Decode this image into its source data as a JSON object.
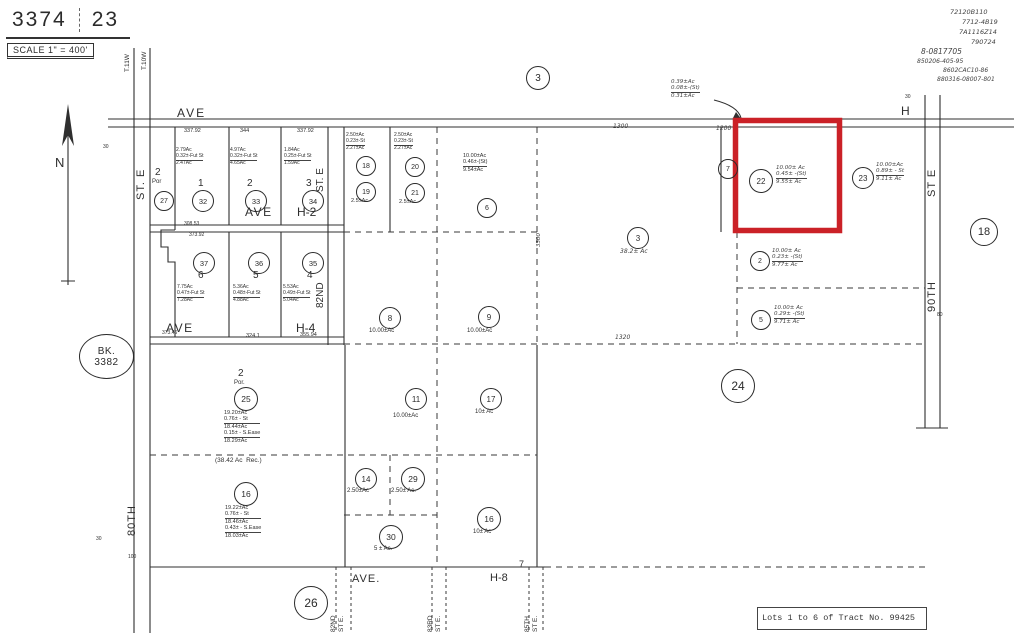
{
  "header": {
    "sheet_number": "3374",
    "page_number": "23",
    "scale_text": "SCALE 1\" = 400'"
  },
  "book": {
    "line1": "BK.",
    "line2": "3382"
  },
  "caption": {
    "text": "Lots 1 to 6 of Tract No. 99425"
  },
  "highlight_color": "#cb2127",
  "handwritten_notes": [
    {
      "name": "recorder-note-1",
      "text": "72120B110",
      "x": 950,
      "y": 9,
      "size": 6.5
    },
    {
      "name": "recorder-note-2",
      "text": "7712-4B19",
      "x": 962,
      "y": 19,
      "size": 6.5
    },
    {
      "name": "recorder-note-3",
      "text": "7A1116Z14",
      "x": 959,
      "y": 29,
      "size": 6.5
    },
    {
      "name": "recorder-note-4",
      "text": "790724",
      "x": 971,
      "y": 39,
      "size": 6.5
    },
    {
      "name": "recorder-note-5",
      "text": "8-0817705",
      "x": 921,
      "y": 48,
      "size": 7.5
    },
    {
      "name": "recorder-note-6",
      "text": "850206-405-95",
      "x": 917,
      "y": 58,
      "size": 6
    },
    {
      "name": "recorder-note-7",
      "text": "8602CAC10-86",
      "x": 943,
      "y": 67,
      "size": 6
    },
    {
      "name": "recorder-note-8",
      "text": "880316-08007-801",
      "x": 937,
      "y": 76,
      "size": 6
    }
  ],
  "labels": [
    {
      "name": "township-label-t11w",
      "text": "T.11W",
      "x": 124,
      "y": 72,
      "size": 6.5,
      "rot": 1
    },
    {
      "name": "township-label-t10w",
      "text": "T.10W",
      "x": 141,
      "y": 70,
      "size": 6.5,
      "rot": 1
    },
    {
      "name": "north-label",
      "text": "N",
      "x": 55,
      "y": 155,
      "size": 13
    },
    {
      "name": "ave-h-label-west",
      "text": "AVE",
      "x": 177,
      "y": 106,
      "size": 12,
      "spacing": 2
    },
    {
      "name": "ave-h-label-east",
      "text": "H",
      "x": 901,
      "y": 104,
      "size": 12
    },
    {
      "name": "dim-337-92-a",
      "text": "337.92",
      "x": 184,
      "y": 128,
      "size": 5.5
    },
    {
      "name": "dim-344",
      "text": "344",
      "x": 240,
      "y": 128,
      "size": 5.5
    },
    {
      "name": "dim-337-92-b",
      "text": "337.92",
      "x": 297,
      "y": 128,
      "size": 5.5
    },
    {
      "name": "dim-1300",
      "text": "1300",
      "x": 613,
      "y": 123,
      "size": 6,
      "hand": 1
    },
    {
      "name": "dim-1200",
      "text": "1200",
      "x": 716,
      "y": 125,
      "size": 6,
      "hand": 1
    },
    {
      "name": "lot-2-por-number",
      "text": "2",
      "x": 155,
      "y": 167,
      "size": 10
    },
    {
      "name": "lot-2-por-label",
      "text": "Por",
      "x": 152,
      "y": 179,
      "size": 6
    },
    {
      "name": "lot-1-number",
      "text": "1",
      "x": 198,
      "y": 178,
      "size": 10
    },
    {
      "name": "lot-2-number",
      "text": "2",
      "x": 247,
      "y": 178,
      "size": 10
    },
    {
      "name": "lot-3-number",
      "text": "3",
      "x": 306,
      "y": 178,
      "size": 10
    },
    {
      "name": "ave-h2-label-ave",
      "text": "AVE",
      "x": 245,
      "y": 205,
      "size": 12,
      "spacing": 1.5
    },
    {
      "name": "ave-h2-label-h2",
      "text": "H-2",
      "x": 297,
      "y": 205,
      "size": 12
    },
    {
      "name": "lot-1-acreage",
      "lines": [
        "2.79Ac",
        "0.32±-Fut St",
        "2.47Ac"
      ],
      "x": 176,
      "y": 148,
      "size": 5,
      "bars": [
        1
      ]
    },
    {
      "name": "lot-2-acreage",
      "lines": [
        "4.97Ac",
        "0.32±-Fut St",
        "4.65Ac"
      ],
      "x": 230,
      "y": 148,
      "size": 5,
      "bars": [
        1
      ]
    },
    {
      "name": "lot-3-acreage",
      "lines": [
        "1.84Ac",
        "0.25±-Fut St",
        "1.59Ac"
      ],
      "x": 284,
      "y": 148,
      "size": 5,
      "bars": [
        1
      ]
    },
    {
      "name": "street-80th-st-e-upper",
      "text": "ST. E",
      "x": 135,
      "y": 200,
      "size": 11,
      "rot": 1,
      "spacing": 1
    },
    {
      "name": "street-80th-label",
      "text": "80TH",
      "x": 126,
      "y": 536,
      "size": 11,
      "rot": 1,
      "spacing": 1
    },
    {
      "name": "tick-30-top-left",
      "text": "30",
      "x": 103,
      "y": 145,
      "size": 5
    },
    {
      "name": "tick-30-bottom-left",
      "text": "30",
      "x": 96,
      "y": 537,
      "size": 5
    },
    {
      "name": "tick-100-bottom-left",
      "text": "100",
      "x": 128,
      "y": 555,
      "size": 5
    },
    {
      "name": "street-82nd-st-e-upper",
      "text": "ST. E",
      "x": 315,
      "y": 192,
      "size": 10,
      "rot": 1
    },
    {
      "name": "street-82nd-label",
      "text": "82ND",
      "x": 315,
      "y": 308,
      "size": 10,
      "rot": 1
    },
    {
      "name": "lot-6-number",
      "text": "6",
      "x": 198,
      "y": 270,
      "size": 10
    },
    {
      "name": "lot-5-number",
      "text": "5",
      "x": 253,
      "y": 270,
      "size": 10
    },
    {
      "name": "lot-4-number",
      "text": "4",
      "x": 307,
      "y": 270,
      "size": 10
    },
    {
      "name": "ave-h4-label-ave",
      "text": "AVE",
      "x": 166,
      "y": 321,
      "size": 12,
      "spacing": 1.5
    },
    {
      "name": "ave-h4-label-h4",
      "text": "H-4",
      "x": 296,
      "y": 321,
      "size": 12
    },
    {
      "name": "lot-6-acreage",
      "lines": [
        "7.75Ac",
        "0.47±-Fut St",
        "7.28Ac"
      ],
      "x": 177,
      "y": 285,
      "size": 5,
      "bars": [
        1
      ]
    },
    {
      "name": "lot-5-acreage",
      "lines": [
        "5.36Ac",
        "0.48±-Fut St",
        "4.88Ac"
      ],
      "x": 233,
      "y": 285,
      "size": 5,
      "bars": [
        1
      ]
    },
    {
      "name": "lot-4-acreage",
      "lines": [
        "5.53Ac",
        "0.49±-Fut St",
        "5.04Ac"
      ],
      "x": 283,
      "y": 285,
      "size": 5,
      "bars": [
        1
      ]
    },
    {
      "name": "dim-308-53",
      "text": "308.53",
      "x": 184,
      "y": 222,
      "size": 5
    },
    {
      "name": "dim-373-92",
      "text": "373.92",
      "x": 189,
      "y": 233,
      "size": 5
    },
    {
      "name": "dim-373-46",
      "text": "373.46",
      "x": 162,
      "y": 331,
      "size": 5
    },
    {
      "name": "dim-324-1",
      "text": "324.1",
      "x": 246,
      "y": 333,
      "size": 5.5
    },
    {
      "name": "dim-355-94",
      "text": "355.94",
      "x": 300,
      "y": 332,
      "size": 5.5
    },
    {
      "name": "parcel-18-acreage",
      "lines": [
        "2.50±Ac",
        "0.23±-St",
        "2.27±Ac"
      ],
      "x": 346,
      "y": 133,
      "size": 5,
      "bars": [
        1
      ]
    },
    {
      "name": "parcel-20-acreage",
      "lines": [
        "2.50±Ac",
        "0.23±-St",
        "2.27±Ac"
      ],
      "x": 394,
      "y": 133,
      "size": 5,
      "bars": [
        1
      ]
    },
    {
      "name": "parcel-19-acreage",
      "text": "2.5±Ac",
      "x": 351,
      "y": 198,
      "size": 5.5
    },
    {
      "name": "parcel-21-acreage",
      "text": "2.5±Ac",
      "x": 399,
      "y": 199,
      "size": 5.5
    },
    {
      "name": "parcel-6-acreage",
      "lines": [
        "10.00±Ac",
        "0.46±-(St)",
        "9.54±Ac"
      ],
      "x": 463,
      "y": 153,
      "size": 5.5,
      "bars": [
        1
      ]
    },
    {
      "name": "parcel-8-acreage",
      "text": "10.00±Ac",
      "x": 369,
      "y": 328,
      "size": 6
    },
    {
      "name": "parcel-9-acreage",
      "text": "10.00±Ac",
      "x": 467,
      "y": 328,
      "size": 6
    },
    {
      "name": "parcel-3-acreage",
      "text": "38.2± Ac",
      "x": 620,
      "y": 248,
      "size": 6,
      "hand": 1
    },
    {
      "name": "dim-1320",
      "text": "1320",
      "x": 615,
      "y": 334,
      "size": 6,
      "hand": 1
    },
    {
      "name": "dim-3300",
      "text": "3300",
      "x": 536,
      "y": 247,
      "size": 5.5,
      "rot": 1,
      "hand": 1
    },
    {
      "name": "road-widening-note",
      "lines": [
        "0.39±Ac",
        "0.08±-(St)",
        "0.31±Ac"
      ],
      "x": 671,
      "y": 79,
      "size": 5.5,
      "hand": 1,
      "bars": [
        1
      ]
    },
    {
      "name": "parcel-22-acreage",
      "lines": [
        "10.00± Ac",
        "0.45± -(St)",
        "9.55± Ac"
      ],
      "x": 776,
      "y": 165,
      "size": 5.5,
      "hand": 1,
      "bars": [
        1
      ]
    },
    {
      "name": "parcel-23-acreage",
      "lines": [
        "10.00±Ac",
        "0.89± - St",
        "9.11± Ac"
      ],
      "x": 876,
      "y": 162,
      "size": 5.5,
      "hand": 1,
      "bars": [
        1
      ]
    },
    {
      "name": "parcel-2-acreage",
      "lines": [
        "10.00± Ac",
        "0.23± -(St)",
        "9.77± Ac"
      ],
      "x": 772,
      "y": 248,
      "size": 5.5,
      "hand": 1,
      "bars": [
        1
      ]
    },
    {
      "name": "parcel-5-acreage",
      "lines": [
        "10.00± Ac",
        "0.29± -(St)",
        "9.71± Ac"
      ],
      "x": 774,
      "y": 305,
      "size": 5.5,
      "hand": 1,
      "bars": [
        1
      ]
    },
    {
      "name": "lot-2-por-south-number",
      "text": "2",
      "x": 238,
      "y": 368,
      "size": 10
    },
    {
      "name": "lot-2-por-south-label",
      "text": "Por.",
      "x": 234,
      "y": 380,
      "size": 6
    },
    {
      "name": "parcel-25-acreage",
      "lines": [
        "19.20±Ac",
        "0.76± - St",
        "18.44±Ac",
        "0.15± - S.Ease",
        "18.29±Ac"
      ],
      "x": 224,
      "y": 410,
      "size": 5.5,
      "bars": [
        1,
        3
      ]
    },
    {
      "name": "record-acreage-note",
      "text": "(38.42 Ac  Rec.)",
      "x": 215,
      "y": 457,
      "size": 6.5
    },
    {
      "name": "parcel-16-acreage",
      "lines": [
        "19.22±Ac",
        "0.76± - St",
        "18.46±Ac",
        "0.43± - S.Ease",
        "18.03±Ac"
      ],
      "x": 225,
      "y": 505,
      "size": 5.5,
      "bars": [
        1,
        3
      ]
    },
    {
      "name": "parcel-11-acreage",
      "text": "10.00±Ac",
      "x": 393,
      "y": 413,
      "size": 6
    },
    {
      "name": "parcel-17-acreage",
      "text": "10± Ac",
      "x": 475,
      "y": 409,
      "size": 6
    },
    {
      "name": "parcel-14-acreage",
      "text": "2.50±Ac",
      "x": 347,
      "y": 488,
      "size": 6
    },
    {
      "name": "parcel-29-acreage",
      "text": "2.50± Ac.",
      "x": 391,
      "y": 488,
      "size": 6
    },
    {
      "name": "parcel-16-south-acreage",
      "text": "10± Ac",
      "x": 473,
      "y": 529,
      "size": 6
    },
    {
      "name": "parcel-30-acreage",
      "text": "5 ± Ac.",
      "x": 374,
      "y": 546,
      "size": 6
    },
    {
      "name": "ave-h8-label-ave",
      "text": "AVE.",
      "x": 352,
      "y": 573,
      "size": 11,
      "spacing": 1
    },
    {
      "name": "ave-h8-label-h8",
      "text": "H-8",
      "x": 490,
      "y": 572,
      "size": 11
    },
    {
      "name": "section-corner-7",
      "text": "7",
      "x": 519,
      "y": 559,
      "size": 9
    },
    {
      "name": "street-82nd-st-e-lower",
      "lines": [
        "82ND",
        "ST E."
      ],
      "x": 330,
      "y": 632,
      "size": 6.5,
      "rot": 1
    },
    {
      "name": "street-83rd-st-e",
      "lines": [
        "83RD",
        "ST E."
      ],
      "x": 427,
      "y": 632,
      "size": 6.5,
      "rot": 1
    },
    {
      "name": "street-85th-st-e",
      "lines": [
        "85TH",
        "ST E."
      ],
      "x": 524,
      "y": 632,
      "size": 6.5,
      "rot": 1
    },
    {
      "name": "street-90th-st-e-upper",
      "text": "ST E",
      "x": 926,
      "y": 197,
      "size": 11,
      "rot": 1,
      "spacing": 1
    },
    {
      "name": "street-90th-label",
      "text": "90TH",
      "x": 926,
      "y": 312,
      "size": 11,
      "rot": 1,
      "spacing": 1
    },
    {
      "name": "tick-30-top-right",
      "text": "30",
      "x": 905,
      "y": 95,
      "size": 5
    },
    {
      "name": "tick-80-right",
      "text": "80",
      "x": 937,
      "y": 313,
      "size": 5
    }
  ],
  "circles": [
    {
      "name": "section-circle-3",
      "num": "3",
      "cx": 537,
      "cy": 77,
      "r": 11,
      "size": 10
    },
    {
      "name": "section-circle-18",
      "num": "18",
      "cx": 983,
      "cy": 231,
      "r": 13,
      "size": 11
    },
    {
      "name": "section-circle-24",
      "num": "24",
      "cx": 737,
      "cy": 385,
      "r": 16,
      "size": 12
    },
    {
      "name": "section-circle-26",
      "num": "26",
      "cx": 310,
      "cy": 602,
      "r": 16,
      "size": 12
    },
    {
      "name": "parcel-circle-27",
      "num": "27",
      "cx": 163,
      "cy": 200,
      "r": 9,
      "size": 7
    },
    {
      "name": "parcel-circle-32",
      "num": "32",
      "cx": 202,
      "cy": 200,
      "r": 10,
      "size": 7.5
    },
    {
      "name": "parcel-circle-33",
      "num": "33",
      "cx": 255,
      "cy": 200,
      "r": 10,
      "size": 7.5
    },
    {
      "name": "parcel-circle-34",
      "num": "34",
      "cx": 312,
      "cy": 200,
      "r": 10,
      "size": 7.5
    },
    {
      "name": "parcel-circle-37",
      "num": "37",
      "cx": 203,
      "cy": 262,
      "r": 10,
      "size": 7.5
    },
    {
      "name": "parcel-circle-36",
      "num": "36",
      "cx": 258,
      "cy": 262,
      "r": 10,
      "size": 7.5
    },
    {
      "name": "parcel-circle-35",
      "num": "35",
      "cx": 312,
      "cy": 262,
      "r": 10,
      "size": 7.5
    },
    {
      "name": "parcel-circle-18",
      "num": "18",
      "cx": 365,
      "cy": 165,
      "r": 9,
      "size": 7
    },
    {
      "name": "parcel-circle-20",
      "num": "20",
      "cx": 414,
      "cy": 166,
      "r": 9,
      "size": 7
    },
    {
      "name": "parcel-circle-19",
      "num": "19",
      "cx": 365,
      "cy": 191,
      "r": 9,
      "size": 7
    },
    {
      "name": "parcel-circle-21",
      "num": "21",
      "cx": 414,
      "cy": 192,
      "r": 9,
      "size": 7
    },
    {
      "name": "parcel-circle-6",
      "num": "6",
      "cx": 486,
      "cy": 207,
      "r": 9,
      "size": 7
    },
    {
      "name": "parcel-circle-8",
      "num": "8",
      "cx": 389,
      "cy": 317,
      "r": 10,
      "size": 8
    },
    {
      "name": "parcel-circle-9",
      "num": "9",
      "cx": 488,
      "cy": 316,
      "r": 10,
      "size": 8
    },
    {
      "name": "parcel-circle-3",
      "num": "3",
      "cx": 637,
      "cy": 237,
      "r": 10,
      "size": 8
    },
    {
      "name": "parcel-circle-7",
      "num": "7",
      "cx": 727,
      "cy": 168,
      "r": 9,
      "size": 7
    },
    {
      "name": "parcel-circle-22",
      "num": "22",
      "cx": 760,
      "cy": 180,
      "r": 11,
      "size": 8
    },
    {
      "name": "parcel-circle-23",
      "num": "23",
      "cx": 862,
      "cy": 177,
      "r": 10,
      "size": 8
    },
    {
      "name": "parcel-circle-2",
      "num": "2",
      "cx": 759,
      "cy": 260,
      "r": 9,
      "size": 7
    },
    {
      "name": "parcel-circle-5",
      "num": "5",
      "cx": 760,
      "cy": 319,
      "r": 9,
      "size": 7
    },
    {
      "name": "parcel-circle-25",
      "num": "25",
      "cx": 245,
      "cy": 398,
      "r": 11,
      "size": 8.5
    },
    {
      "name": "parcel-circle-16",
      "num": "16",
      "cx": 245,
      "cy": 493,
      "r": 11,
      "size": 8.5
    },
    {
      "name": "parcel-circle-11",
      "num": "11",
      "cx": 415,
      "cy": 398,
      "r": 10,
      "size": 8
    },
    {
      "name": "parcel-circle-17",
      "num": "17",
      "cx": 490,
      "cy": 398,
      "r": 10,
      "size": 8
    },
    {
      "name": "parcel-circle-14",
      "num": "14",
      "cx": 365,
      "cy": 478,
      "r": 10,
      "size": 8
    },
    {
      "name": "parcel-circle-29",
      "num": "29",
      "cx": 412,
      "cy": 478,
      "r": 11,
      "size": 8.5
    },
    {
      "name": "parcel-circle-16-south",
      "num": "16",
      "cx": 488,
      "cy": 518,
      "r": 11,
      "size": 8.5
    },
    {
      "name": "parcel-circle-30",
      "num": "30",
      "cx": 390,
      "cy": 536,
      "r": 11,
      "size": 8.5
    }
  ]
}
